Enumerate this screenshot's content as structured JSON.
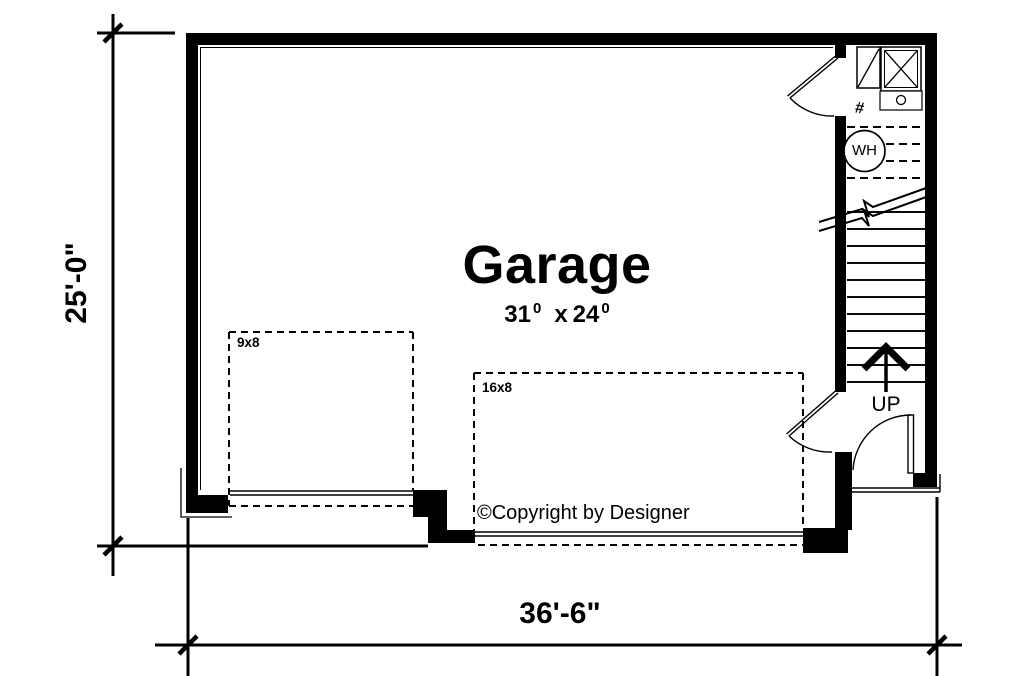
{
  "title": {
    "room": "Garage"
  },
  "room_size": {
    "a": "31",
    "a_sup": "0",
    "sep": "x",
    "b": "24",
    "b_sup": "0"
  },
  "doors": {
    "small_label": "9x8",
    "large_label": "16x8"
  },
  "stairs": {
    "direction_label": "UP"
  },
  "fixtures": {
    "water_heater": "WH",
    "hash_symbol": "#"
  },
  "copyright": {
    "text": "©Copyright by Designer"
  },
  "dimensions": {
    "height": "25'-0\"",
    "width": "36'-6\""
  },
  "colors": {
    "ink": "#000000",
    "background": "#ffffff"
  }
}
